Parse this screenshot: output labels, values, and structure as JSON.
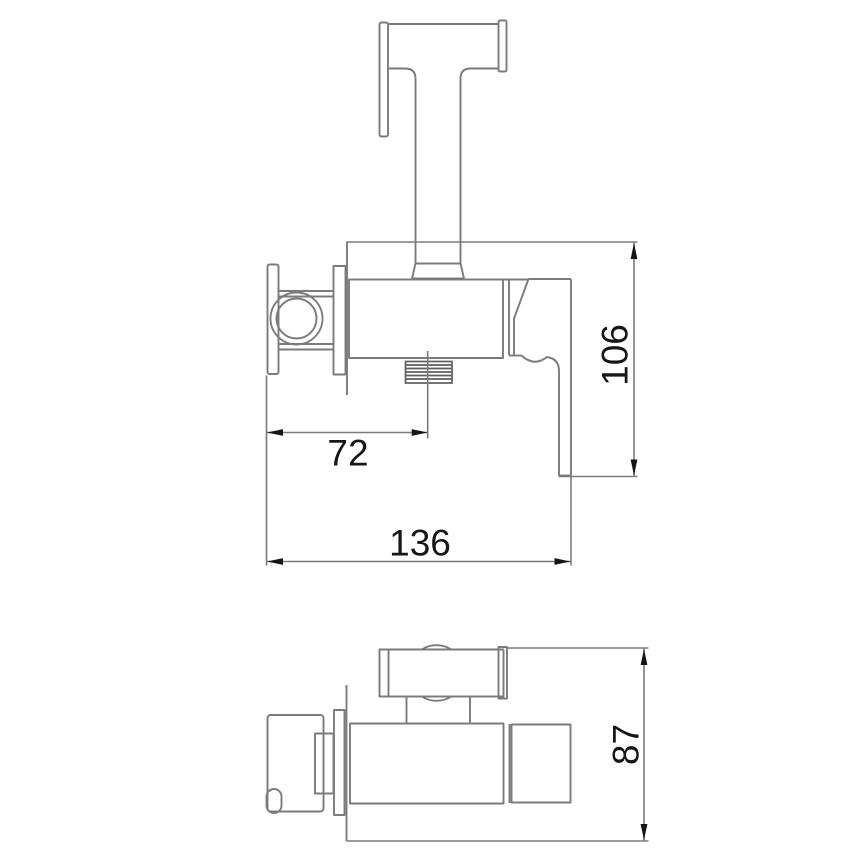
{
  "dimensions": {
    "height": "106",
    "outlet_offset": "72",
    "width": "136",
    "depth": "87"
  },
  "colors": {
    "line": "#7b7b7b",
    "thread": "#5f5f5f",
    "text": "#161616",
    "background": "#ffffff"
  }
}
